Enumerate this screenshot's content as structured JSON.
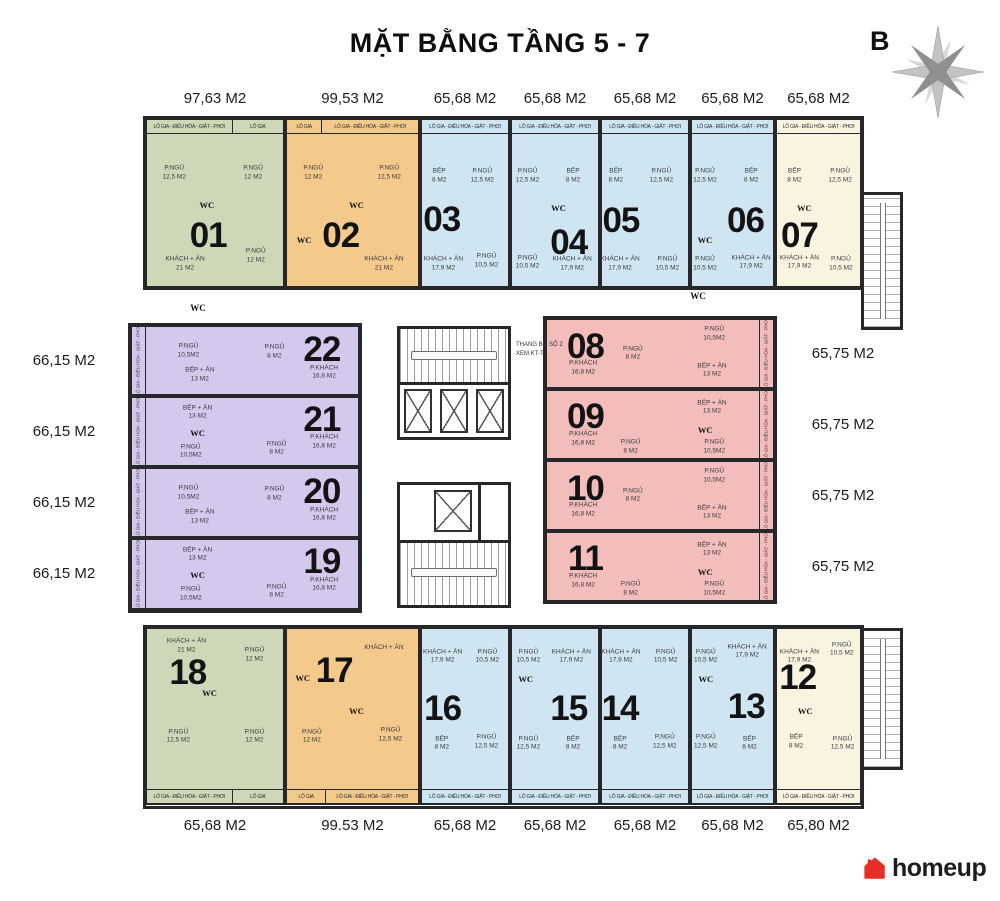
{
  "title": "MẶT BẰNG TẦNG 5 - 7",
  "compass_label": "B",
  "brand": {
    "name": "homeup"
  },
  "stair_note": {
    "l1": "THANG BỘ SỐ 2",
    "l2": "XEM KT-T"
  },
  "balcony_full": "LÔ GIA - ĐIỀU HÒA - GIẶT - PHƠI",
  "balcony_short": "LÔ GIA",
  "palette": {
    "green": "#ccd8b8",
    "orange": "#f3c98c",
    "blue": "#cfe6f2",
    "cream": "#f8f4e0",
    "purple": "#d4c8ec",
    "red": "#f2bdba",
    "wall": "#26262b"
  },
  "corridor_labels": [
    {
      "t": "WC",
      "x": 198,
      "y": 308
    },
    {
      "t": "WC",
      "x": 698,
      "y": 296
    }
  ],
  "apartments": [
    {
      "no": "01",
      "area": "97,63 M2",
      "color": "green",
      "row": "top",
      "x": 145,
      "y": 118,
      "w": 140,
      "h": 170,
      "num": [
        45,
        70
      ],
      "strips": [
        {
          "k": "full",
          "w": 63
        },
        {
          "k": "short",
          "w": 37
        }
      ],
      "rooms": [
        {
          "l": "P.NGỦ",
          "s": "12,5 M2",
          "x": 20,
          "y": 32
        },
        {
          "l": "P.NGỦ",
          "s": "12 M2",
          "x": 78,
          "y": 32
        },
        {
          "l": "WC",
          "x": 44,
          "y": 51,
          "wc": 1
        },
        {
          "l": "KHÁCH + ĂN",
          "s": "21 M2",
          "x": 28,
          "y": 87
        },
        {
          "l": "P.NGỦ",
          "s": "12 M2",
          "x": 80,
          "y": 82
        }
      ]
    },
    {
      "no": "02",
      "area": "99,53 M2",
      "color": "orange",
      "row": "top",
      "x": 285,
      "y": 118,
      "w": 135,
      "h": 170,
      "num": [
        41,
        70
      ],
      "strips": [
        {
          "k": "short",
          "w": 27
        },
        {
          "k": "full",
          "w": 73
        }
      ],
      "rooms": [
        {
          "l": "P.NGỦ",
          "s": "12 M2",
          "x": 20,
          "y": 32
        },
        {
          "l": "P.NGỦ",
          "s": "12,5 M2",
          "x": 78,
          "y": 32
        },
        {
          "l": "WC",
          "x": 53,
          "y": 51,
          "wc": 1
        },
        {
          "l": "WC",
          "x": 13,
          "y": 72,
          "wc": 1
        },
        {
          "l": "KHÁCH + ĂN",
          "s": "21 M2",
          "x": 74,
          "y": 87
        }
      ]
    },
    {
      "no": "03",
      "area": "65,68 M2",
      "color": "blue",
      "row": "top",
      "x": 420,
      "y": 118,
      "w": 90,
      "h": 170,
      "num": [
        23,
        60
      ],
      "strips": [
        {
          "k": "full",
          "w": 100
        }
      ],
      "rooms": [
        {
          "l": "BẾP",
          "s": "8 M2",
          "x": 20,
          "y": 34
        },
        {
          "l": "P.NGỦ",
          "s": "12,5 M2",
          "x": 70,
          "y": 34
        },
        {
          "l": "KHÁCH + ĂN",
          "s": "17,9 M2",
          "x": 25,
          "y": 87
        },
        {
          "l": "P.NGỦ",
          "s": "10,5 M2",
          "x": 75,
          "y": 85
        }
      ]
    },
    {
      "no": "04",
      "area": "65,68 M2",
      "color": "blue",
      "row": "top",
      "x": 510,
      "y": 118,
      "w": 90,
      "h": 170,
      "num": [
        66,
        74
      ],
      "strips": [
        {
          "k": "full",
          "w": 100
        }
      ],
      "rooms": [
        {
          "l": "P.NGỦ",
          "s": "12,5 M2",
          "x": 18,
          "y": 34
        },
        {
          "l": "BẾP",
          "s": "8 M2",
          "x": 71,
          "y": 34
        },
        {
          "l": "WC",
          "x": 54,
          "y": 53,
          "wc": 1
        },
        {
          "l": "P.NGỦ",
          "s": "10,5 M2",
          "x": 18,
          "y": 86
        },
        {
          "l": "KHÁCH + ĂN",
          "s": "17,9 M2",
          "x": 70,
          "y": 87
        }
      ]
    },
    {
      "no": "05",
      "area": "65,68 M2",
      "color": "blue",
      "row": "top",
      "x": 600,
      "y": 118,
      "w": 90,
      "h": 170,
      "num": [
        22,
        61
      ],
      "strips": [
        {
          "k": "full",
          "w": 100
        }
      ],
      "rooms": [
        {
          "l": "BẾP",
          "s": "8 M2",
          "x": 16,
          "y": 34
        },
        {
          "l": "P.NGỦ",
          "s": "12,5 M2",
          "x": 69,
          "y": 34
        },
        {
          "l": "KHÁCH + ĂN",
          "s": "17,9 M2",
          "x": 21,
          "y": 87
        },
        {
          "l": "P.NGỦ",
          "s": "10,5 M2",
          "x": 76,
          "y": 87
        }
      ]
    },
    {
      "no": "06",
      "area": "65,68 M2",
      "color": "blue",
      "row": "top",
      "x": 690,
      "y": 118,
      "w": 85,
      "h": 170,
      "num": [
        66,
        61
      ],
      "strips": [
        {
          "k": "full",
          "w": 100
        }
      ],
      "rooms": [
        {
          "l": "P.NGỦ",
          "s": "12,5 M2",
          "x": 16,
          "y": 34
        },
        {
          "l": "BẾP",
          "s": "8 M2",
          "x": 73,
          "y": 34
        },
        {
          "l": "WC",
          "x": 16,
          "y": 72,
          "wc": 1
        },
        {
          "l": "P.NGỦ",
          "s": "10,5 M2",
          "x": 16,
          "y": 87
        },
        {
          "l": "KHÁCH + ĂN",
          "s": "17,9 M2",
          "x": 73,
          "y": 86
        }
      ]
    },
    {
      "no": "07",
      "area": "65,68 M2",
      "color": "cream",
      "row": "top",
      "x": 775,
      "y": 118,
      "w": 87,
      "h": 170,
      "num": [
        27,
        70
      ],
      "strips": [
        {
          "k": "full",
          "w": 100
        }
      ],
      "rooms": [
        {
          "l": "BẾP",
          "s": "8 M2",
          "x": 21,
          "y": 34
        },
        {
          "l": "P.NGỦ",
          "s": "12,5 M2",
          "x": 76,
          "y": 34
        },
        {
          "l": "WC",
          "x": 33,
          "y": 53,
          "wc": 1
        },
        {
          "l": "KHÁCH + ĂN",
          "s": "17,9 M2",
          "x": 27,
          "y": 86
        },
        {
          "l": "P.NGỦ",
          "s": "10,5 M2",
          "x": 77,
          "y": 87
        }
      ]
    },
    {
      "no": "22",
      "area": "66,15 M2",
      "color": "purple",
      "row": "left",
      "x": 130,
      "y": 325,
      "w": 230,
      "h": 71,
      "num": [
        84,
        34
      ],
      "rooms": [
        {
          "l": "P.NGỦ",
          "s": "10,5M2",
          "x": 25,
          "y": 36
        },
        {
          "l": "P.NGỦ",
          "s": "8 M2",
          "x": 63,
          "y": 38
        },
        {
          "l": "BẾP + ĂN",
          "s": "13 M2",
          "x": 30,
          "y": 72
        },
        {
          "l": "P.KHÁCH",
          "s": "16,8 M2",
          "x": 85,
          "y": 68
        }
      ]
    },
    {
      "no": "21",
      "area": "66,15 M2",
      "color": "purple",
      "row": "left",
      "x": 130,
      "y": 396,
      "w": 230,
      "h": 71,
      "num": [
        84,
        33
      ],
      "rooms": [
        {
          "l": "BẾP + ĂN",
          "s": "13 M2",
          "x": 29,
          "y": 22
        },
        {
          "l": "WC",
          "x": 29,
          "y": 52,
          "wc": 1
        },
        {
          "l": "P.NGỦ",
          "s": "10,5M2",
          "x": 26,
          "y": 80
        },
        {
          "l": "P.NGỦ",
          "s": "8 M2",
          "x": 64,
          "y": 76
        },
        {
          "l": "P.KHÁCH",
          "s": "16,8 M2",
          "x": 85,
          "y": 66
        }
      ]
    },
    {
      "no": "20",
      "area": "66,15 M2",
      "color": "purple",
      "row": "left",
      "x": 130,
      "y": 467,
      "w": 230,
      "h": 71,
      "num": [
        84,
        34
      ],
      "rooms": [
        {
          "l": "P.NGỦ",
          "s": "10,5M2",
          "x": 25,
          "y": 36
        },
        {
          "l": "P.NGỦ",
          "s": "8 M2",
          "x": 63,
          "y": 38
        },
        {
          "l": "BẾP + ĂN",
          "s": "13 M2",
          "x": 30,
          "y": 72
        },
        {
          "l": "P.KHÁCH",
          "s": "16,8 M2",
          "x": 85,
          "y": 68
        }
      ]
    },
    {
      "no": "19",
      "area": "66,15 M2",
      "color": "purple",
      "row": "left",
      "x": 130,
      "y": 538,
      "w": 230,
      "h": 72,
      "num": [
        84,
        33
      ],
      "rooms": [
        {
          "l": "BẾP + ĂN",
          "s": "13 M2",
          "x": 29,
          "y": 22
        },
        {
          "l": "WC",
          "x": 29,
          "y": 52,
          "wc": 1
        },
        {
          "l": "P.NGỦ",
          "s": "10,5M2",
          "x": 26,
          "y": 80
        },
        {
          "l": "P.NGỦ",
          "s": "8 M2",
          "x": 64,
          "y": 76
        },
        {
          "l": "P.KHÁCH",
          "s": "16,8 M2",
          "x": 85,
          "y": 66
        }
      ]
    },
    {
      "no": "08",
      "area": "65,75 M2",
      "color": "red",
      "row": "right",
      "x": 545,
      "y": 318,
      "w": 230,
      "h": 71,
      "num": [
        17,
        40
      ],
      "rooms": [
        {
          "l": "P.KHÁCH",
          "s": "16,8 M2",
          "x": 16,
          "y": 72
        },
        {
          "l": "P.NGỦ",
          "s": "8 M2",
          "x": 38,
          "y": 50
        },
        {
          "l": "P.NGỦ",
          "s": "10,5M2",
          "x": 74,
          "y": 21
        },
        {
          "l": "BẾP + ĂN",
          "s": "13 M2",
          "x": 73,
          "y": 76
        }
      ]
    },
    {
      "no": "09",
      "area": "65,75 M2",
      "color": "red",
      "row": "right",
      "x": 545,
      "y": 389,
      "w": 230,
      "h": 71,
      "num": [
        17,
        39
      ],
      "rooms": [
        {
          "l": "P.KHÁCH",
          "s": "16,8 M2",
          "x": 16,
          "y": 72
        },
        {
          "l": "P.NGỦ",
          "s": "8 M2",
          "x": 37,
          "y": 84
        },
        {
          "l": "BẾP + ĂN",
          "s": "13 M2",
          "x": 73,
          "y": 25
        },
        {
          "l": "WC",
          "x": 70,
          "y": 58,
          "wc": 1
        },
        {
          "l": "P.NGỦ",
          "s": "10,5M2",
          "x": 74,
          "y": 84
        }
      ]
    },
    {
      "no": "10",
      "area": "65,75 M2",
      "color": "red",
      "row": "right",
      "x": 545,
      "y": 460,
      "w": 230,
      "h": 71,
      "num": [
        17,
        40
      ],
      "rooms": [
        {
          "l": "P.KHÁCH",
          "s": "16,8 M2",
          "x": 16,
          "y": 72
        },
        {
          "l": "P.NGỦ",
          "s": "8 M2",
          "x": 38,
          "y": 50
        },
        {
          "l": "P.NGỦ",
          "s": "10,5M2",
          "x": 74,
          "y": 21
        },
        {
          "l": "BẾP + ĂN",
          "s": "13 M2",
          "x": 73,
          "y": 76
        }
      ]
    },
    {
      "no": "11",
      "area": "65,75 M2",
      "color": "red",
      "row": "right",
      "x": 545,
      "y": 531,
      "w": 230,
      "h": 71,
      "num": [
        17,
        39
      ],
      "rooms": [
        {
          "l": "P.KHÁCH",
          "s": "16,8 M2",
          "x": 16,
          "y": 72
        },
        {
          "l": "P.NGỦ",
          "s": "8 M2",
          "x": 37,
          "y": 84
        },
        {
          "l": "BẾP + ĂN",
          "s": "13 M2",
          "x": 73,
          "y": 25
        },
        {
          "l": "WC",
          "x": 70,
          "y": 58,
          "wc": 1
        },
        {
          "l": "P.NGỦ",
          "s": "10,5M2",
          "x": 74,
          "y": 84
        }
      ]
    },
    {
      "no": "18",
      "area": "65,68 M2",
      "color": "green",
      "row": "bottom",
      "x": 145,
      "y": 627,
      "w": 140,
      "h": 178,
      "num": [
        30,
        25
      ],
      "strips": [
        {
          "k": "full",
          "w": 63
        },
        {
          "k": "short",
          "w": 37
        }
      ],
      "rooms": [
        {
          "l": "KHÁCH + ĂN",
          "s": "21 M2",
          "x": 29,
          "y": 10
        },
        {
          "l": "P.NGỦ",
          "s": "12 M2",
          "x": 79,
          "y": 15
        },
        {
          "l": "WC",
          "x": 46,
          "y": 37,
          "wc": 1
        },
        {
          "l": "P.NGỦ",
          "s": "12,5 M2",
          "x": 23,
          "y": 62
        },
        {
          "l": "P.NGỦ",
          "s": "12 M2",
          "x": 79,
          "y": 62
        }
      ]
    },
    {
      "no": "17",
      "area": "99.53 M2",
      "color": "orange",
      "row": "bottom",
      "x": 285,
      "y": 627,
      "w": 135,
      "h": 178,
      "num": [
        36,
        24
      ],
      "strips": [
        {
          "k": "short",
          "w": 30
        },
        {
          "k": "full",
          "w": 70
        }
      ],
      "rooms": [
        {
          "l": "KHÁCH + ĂN",
          "x": 74,
          "y": 11
        },
        {
          "l": "WC",
          "x": 12,
          "y": 28,
          "wc": 1
        },
        {
          "l": "WC",
          "x": 53,
          "y": 47,
          "wc": 1
        },
        {
          "l": "P.NGỦ",
          "s": "12 M2",
          "x": 19,
          "y": 62
        },
        {
          "l": "P.NGỦ",
          "s": "12,5 M2",
          "x": 79,
          "y": 61
        }
      ]
    },
    {
      "no": "16",
      "area": "65,68 M2",
      "color": "blue",
      "row": "bottom",
      "x": 420,
      "y": 627,
      "w": 90,
      "h": 178,
      "num": [
        24,
        46
      ],
      "strips": [
        {
          "k": "full",
          "w": 100
        }
      ],
      "rooms": [
        {
          "l": "KHÁCH + ĂN",
          "s": "17,9 M2",
          "x": 24,
          "y": 16
        },
        {
          "l": "P.NGỦ",
          "s": "10,5 M2",
          "x": 76,
          "y": 16
        },
        {
          "l": "BẾP",
          "s": "8 M2",
          "x": 23,
          "y": 66
        },
        {
          "l": "P.NGỦ",
          "s": "12,5 M2",
          "x": 75,
          "y": 65
        }
      ]
    },
    {
      "no": "15",
      "area": "65,68 M2",
      "color": "blue",
      "row": "bottom",
      "x": 510,
      "y": 627,
      "w": 90,
      "h": 178,
      "num": [
        66,
        46
      ],
      "strips": [
        {
          "k": "full",
          "w": 100
        }
      ],
      "rooms": [
        {
          "l": "P.NGỦ",
          "s": "10,5 M2",
          "x": 19,
          "y": 16
        },
        {
          "l": "WC",
          "x": 16,
          "y": 29,
          "wc": 1
        },
        {
          "l": "KHÁCH + ĂN",
          "s": "17,9 M2",
          "x": 69,
          "y": 16
        },
        {
          "l": "P.NGỦ",
          "s": "12,5 M2",
          "x": 19,
          "y": 66
        },
        {
          "l": "BẾP",
          "s": "8 M2",
          "x": 71,
          "y": 66
        }
      ]
    },
    {
      "no": "14",
      "area": "65,68 M2",
      "color": "blue",
      "row": "bottom",
      "x": 600,
      "y": 627,
      "w": 90,
      "h": 178,
      "num": [
        21,
        46
      ],
      "strips": [
        {
          "k": "full",
          "w": 100
        }
      ],
      "rooms": [
        {
          "l": "KHÁCH + ĂN",
          "s": "17,9 M2",
          "x": 22,
          "y": 16
        },
        {
          "l": "P.NGỦ",
          "s": "10,5 M2",
          "x": 74,
          "y": 16
        },
        {
          "l": "BẾP",
          "s": "8 M2",
          "x": 21,
          "y": 66
        },
        {
          "l": "P.NGỦ",
          "s": "12,5 M2",
          "x": 73,
          "y": 65
        }
      ]
    },
    {
      "no": "13",
      "area": "65,68 M2",
      "color": "blue",
      "row": "bottom",
      "x": 690,
      "y": 627,
      "w": 85,
      "h": 178,
      "num": [
        67,
        45
      ],
      "strips": [
        {
          "k": "full",
          "w": 100
        }
      ],
      "rooms": [
        {
          "l": "P.NGỦ",
          "s": "10,5 M2",
          "x": 17,
          "y": 16
        },
        {
          "l": "WC",
          "x": 17,
          "y": 29,
          "wc": 1
        },
        {
          "l": "KHÁCH + ĂN",
          "s": "17,9 M2",
          "x": 68,
          "y": 13
        },
        {
          "l": "P.NGỦ",
          "s": "12,5 M2",
          "x": 17,
          "y": 65
        },
        {
          "l": "BẾP",
          "s": "8 M2",
          "x": 71,
          "y": 66
        }
      ]
    },
    {
      "no": "12",
      "area": "65,80 M2",
      "color": "cream",
      "row": "bottom",
      "x": 775,
      "y": 627,
      "w": 87,
      "h": 178,
      "num": [
        25,
        28
      ],
      "strips": [
        {
          "k": "full",
          "w": 100
        }
      ],
      "rooms": [
        {
          "l": "KHÁCH + ĂN",
          "s": "17,9 M2",
          "x": 27,
          "y": 16
        },
        {
          "l": "P.NGỦ",
          "s": "10,5 M2",
          "x": 78,
          "y": 12
        },
        {
          "l": "WC",
          "x": 34,
          "y": 47,
          "wc": 1
        },
        {
          "l": "BẾP",
          "s": "8 M2",
          "x": 23,
          "y": 65
        },
        {
          "l": "P.NGỦ",
          "s": "12,5 M2",
          "x": 79,
          "y": 66
        }
      ]
    }
  ]
}
